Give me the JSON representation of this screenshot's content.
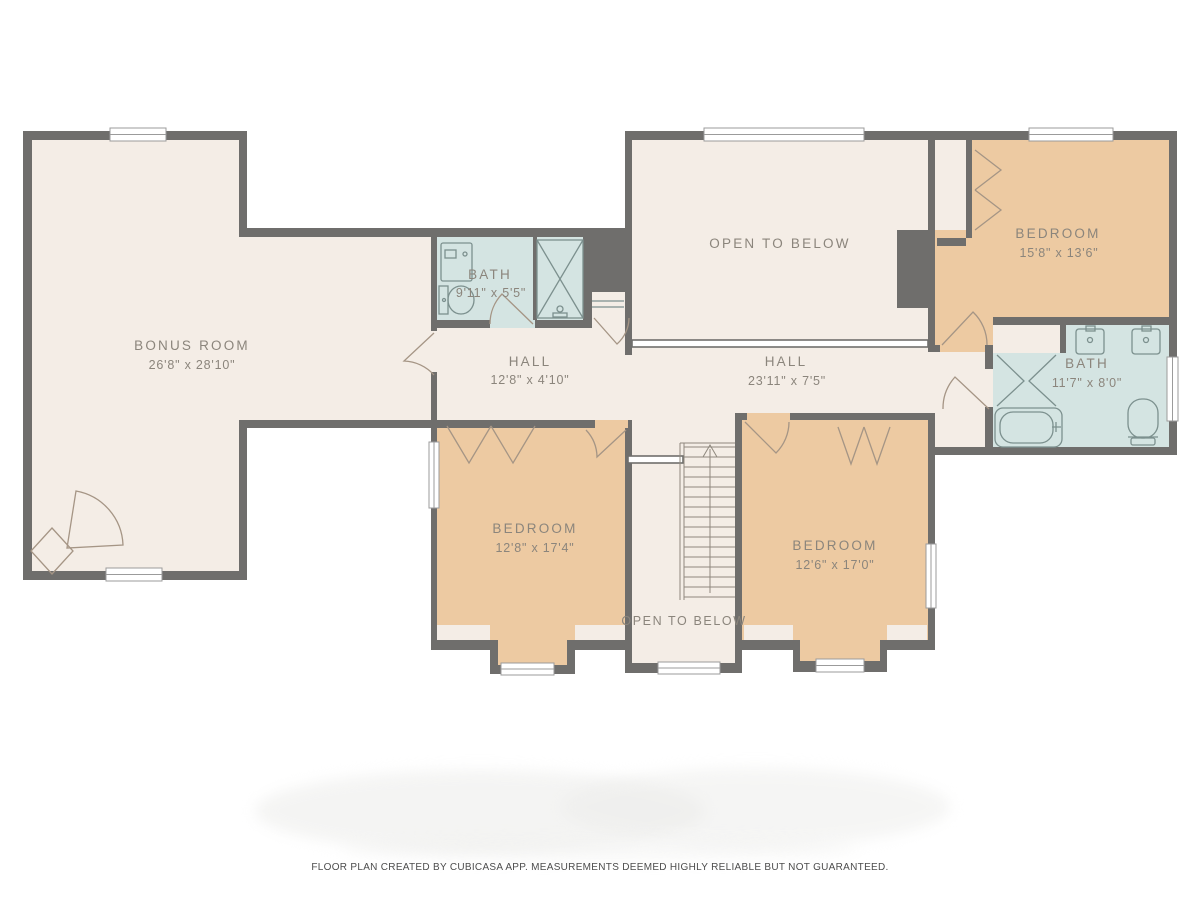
{
  "palette": {
    "background": "#ffffff",
    "wall": "#6f6e6c",
    "floor": "#f4ede6",
    "bedroom": "#edcaa2",
    "bath": "#d4e4e2",
    "label": "#8b857c",
    "door": "#a59585",
    "fixture": "#7c908e",
    "footer": "#4c4c4c"
  },
  "rooms": [
    {
      "id": "bonus-room",
      "name": "BONUS ROOM",
      "dims": "26'8\" x 28'10\""
    },
    {
      "id": "bath-middle",
      "name": "BATH",
      "dims": "9'11\" x 5'5\""
    },
    {
      "id": "hall-left",
      "name": "HALL",
      "dims": "12'8\" x 4'10\""
    },
    {
      "id": "open-to-below-top",
      "name": "OPEN TO BELOW",
      "dims": ""
    },
    {
      "id": "bedroom-top-right",
      "name": "BEDROOM",
      "dims": "15'8\" x 13'6\""
    },
    {
      "id": "hall-right",
      "name": "HALL",
      "dims": "23'11\" x 7'5\""
    },
    {
      "id": "bath-right",
      "name": "BATH",
      "dims": "11'7\" x 8'0\""
    },
    {
      "id": "bedroom-left",
      "name": "BEDROOM",
      "dims": "12'8\" x 17'4\""
    },
    {
      "id": "bedroom-right",
      "name": "BEDROOM",
      "dims": "12'6\" x 17'0\""
    },
    {
      "id": "open-to-below-stairs",
      "name": "OPEN TO BELOW",
      "dims": ""
    }
  ],
  "footer": {
    "disclaimer": "FLOOR PLAN CREATED BY CUBICASA APP. MEASUREMENTS DEEMED HIGHLY RELIABLE BUT NOT GUARANTEED."
  }
}
